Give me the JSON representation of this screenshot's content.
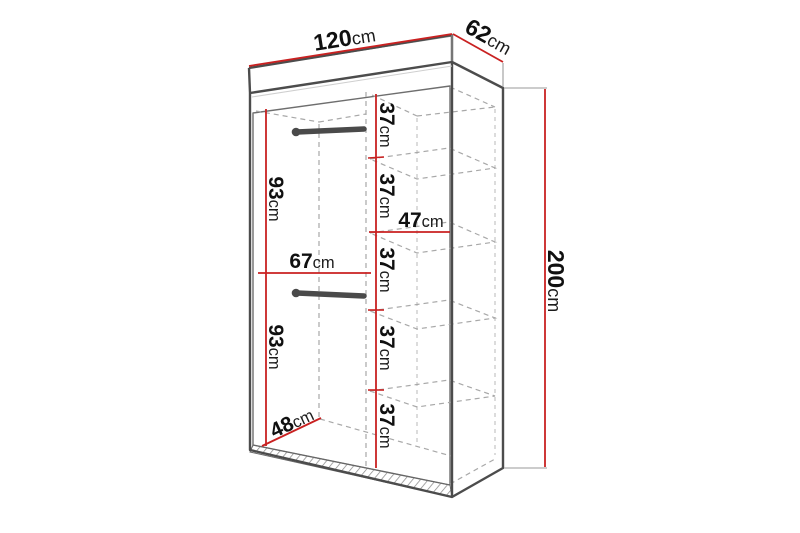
{
  "diagram_type": "wardrobe dimension drawing",
  "unit": "cm",
  "colors": {
    "dimension_line": "#c92121",
    "outline": "#4c4c4c",
    "hidden_line": "#a8a8a8",
    "rail": "#4a4a4a",
    "label_number": "#101010",
    "label_unit": "#1c1c1c",
    "background": "#ffffff"
  },
  "labels": {
    "width": {
      "num": "120",
      "unit": "cm"
    },
    "depth": {
      "num": "62",
      "unit": "cm"
    },
    "height": {
      "num": "200",
      "unit": "cm"
    },
    "hanging_top": {
      "num": "93",
      "unit": "cm"
    },
    "hanging_bottom": {
      "num": "93",
      "unit": "cm"
    },
    "left_section_width": {
      "num": "67",
      "unit": "cm"
    },
    "right_section_width": {
      "num": "47",
      "unit": "cm"
    },
    "interior_depth": {
      "num": "48",
      "unit": "cm"
    },
    "shelf_gap_1": {
      "num": "37",
      "unit": "cm"
    },
    "shelf_gap_2": {
      "num": "37",
      "unit": "cm"
    },
    "shelf_gap_3": {
      "num": "37",
      "unit": "cm"
    },
    "shelf_gap_4": {
      "num": "37",
      "unit": "cm"
    },
    "shelf_gap_5": {
      "num": "37",
      "unit": "cm"
    }
  }
}
